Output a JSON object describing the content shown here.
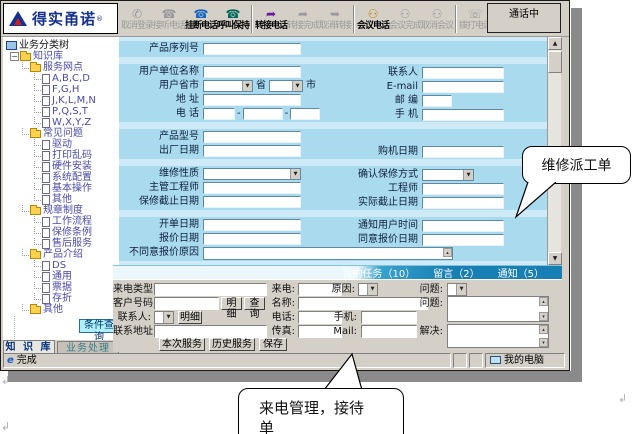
{
  "logo": {
    "brand": "得实甬诺",
    "reg": "®"
  },
  "toolbar": {
    "status": "通话中",
    "buttons": [
      {
        "label": "取消登录",
        "name": "cancel-login-button",
        "icon": "cancel-login-icon",
        "icon_char": "✆",
        "icon_color": "#8a8a8a",
        "enabled": false
      },
      {
        "label": "接听电话",
        "name": "answer-call-button",
        "icon": "answer-call-icon",
        "icon_char": "☎",
        "icon_color": "#8a8a8a",
        "enabled": false
      },
      {
        "label": "挂断电话",
        "name": "hangup-call-button",
        "icon": "hangup-call-icon",
        "icon_char": "☎",
        "icon_color": "#1565c0",
        "enabled": true
      },
      {
        "label": "呼叫保持",
        "name": "hold-call-button",
        "icon": "hold-call-icon",
        "icon_char": "☎",
        "icon_color": "#00695c",
        "enabled": true
      },
      {
        "label": "转接电话",
        "name": "transfer-call-button",
        "icon": "transfer-call-icon",
        "icon_char": "➦",
        "icon_color": "#6a1b9a",
        "enabled": true,
        "group_start": true
      },
      {
        "label": "转接完成",
        "name": "transfer-complete-button",
        "icon": "transfer-complete-icon",
        "icon_char": "➦",
        "icon_color": "#9a9a9a",
        "enabled": false
      },
      {
        "label": "取消转接",
        "name": "cancel-transfer-button",
        "icon": "cancel-transfer-icon",
        "icon_char": "➥",
        "icon_color": "#9a9a9a",
        "enabled": false
      },
      {
        "label": "会议电话",
        "name": "conference-call-button",
        "icon": "conference-call-icon",
        "icon_char": "⚇",
        "icon_color": "#c87f0a",
        "enabled": true,
        "group_start": true
      },
      {
        "label": "会议完成",
        "name": "conference-complete-button",
        "icon": "conference-complete-icon",
        "icon_char": "⚇",
        "icon_color": "#9a9a9a",
        "enabled": false
      },
      {
        "label": "取消会议",
        "name": "cancel-conference-button",
        "icon": "cancel-conference-icon",
        "icon_char": "⚇",
        "icon_color": "#9a9a9a",
        "enabled": false
      },
      {
        "label": "拨打电话",
        "name": "dial-call-button",
        "icon": "dial-call-icon",
        "icon_char": "☏",
        "icon_color": "#555555",
        "enabled": false,
        "group_start": true,
        "dropdown": true
      }
    ]
  },
  "sidebar": {
    "root": "业务分类树",
    "tree": [
      {
        "label": "知识库",
        "level": 1,
        "type": "folder-open",
        "expander": "−"
      },
      {
        "label": "服务网点",
        "level": 2,
        "type": "folder-open"
      },
      {
        "label": "A,B,C,D",
        "level": 3,
        "type": "doc"
      },
      {
        "label": "F,G,H",
        "level": 3,
        "type": "doc"
      },
      {
        "label": "J,K,L,M,N",
        "level": 3,
        "type": "doc"
      },
      {
        "label": "P,Q,S,T",
        "level": 3,
        "type": "doc"
      },
      {
        "label": "W,X,Y,Z",
        "level": 3,
        "type": "doc"
      },
      {
        "label": "常见问题",
        "level": 2,
        "type": "folder-open"
      },
      {
        "label": "驱动",
        "level": 3,
        "type": "doc"
      },
      {
        "label": "打印乱码",
        "level": 3,
        "type": "doc"
      },
      {
        "label": "硬件安装",
        "level": 3,
        "type": "doc"
      },
      {
        "label": "系统配置",
        "level": 3,
        "type": "doc"
      },
      {
        "label": "基本操作",
        "level": 3,
        "type": "doc"
      },
      {
        "label": "其他",
        "level": 3,
        "type": "doc"
      },
      {
        "label": "规章制度",
        "level": 2,
        "type": "folder-open"
      },
      {
        "label": "工作流程",
        "level": 3,
        "type": "doc"
      },
      {
        "label": "保修条例",
        "level": 3,
        "type": "doc"
      },
      {
        "label": "售后服务",
        "level": 3,
        "type": "doc"
      },
      {
        "label": "产品介绍",
        "level": 2,
        "type": "folder-open"
      },
      {
        "label": "DS",
        "level": 3,
        "type": "doc"
      },
      {
        "label": "通用",
        "level": 3,
        "type": "doc"
      },
      {
        "label": "票据",
        "level": 3,
        "type": "doc"
      },
      {
        "label": "存折",
        "level": 3,
        "type": "doc"
      },
      {
        "label": "其他",
        "level": 2,
        "type": "folder-closed"
      }
    ],
    "query_button": "条件查询",
    "tabs": [
      "知 识 库",
      "业务处理"
    ]
  },
  "form": {
    "province": {
      "p1": "省",
      "p2": "市"
    },
    "phone_sep": "-",
    "sections": [
      {
        "rows": [
          {
            "l": "产品序列号",
            "f": {
              "t": "text",
              "w": 98
            }
          }
        ]
      },
      {
        "rows": [
          {
            "l": "用户单位名称",
            "f": {
              "t": "text",
              "w": 98
            },
            "l2": "联系人",
            "f2": {
              "t": "text",
              "w": 82
            }
          },
          {
            "l": "用户省市",
            "f": {
              "t": "prov"
            },
            "l2": "E-mail",
            "f2": {
              "t": "text",
              "w": 82
            }
          },
          {
            "l": "地 址",
            "f": {
              "t": "text",
              "w": 98
            },
            "l2": "邮 编",
            "f2": {
              "t": "text",
              "w": 30
            }
          },
          {
            "l": "电 话",
            "f": {
              "t": "phone"
            },
            "l2": "手 机",
            "f2": {
              "t": "text",
              "w": 82
            }
          }
        ]
      },
      {
        "rows": [
          {
            "l": "产品型号",
            "f": {
              "t": "text",
              "w": 98
            }
          },
          {
            "l": "出厂日期",
            "f": {
              "t": "text",
              "w": 98
            },
            "l2": "购机日期",
            "f2": {
              "t": "text",
              "w": 82
            }
          }
        ]
      },
      {
        "rows": [
          {
            "l": "维修性质",
            "f": {
              "t": "select",
              "w": 98
            },
            "l2": "确认保修方式",
            "f2": {
              "t": "select",
              "w": 52
            }
          },
          {
            "l": "主管工程师",
            "f": {
              "t": "text",
              "w": 98
            },
            "l2": "工程师",
            "f2": {
              "t": "text",
              "w": 82
            }
          },
          {
            "l": "保修截止日期",
            "f": {
              "t": "text",
              "w": 98
            },
            "l2": "实际截止日期",
            "f2": {
              "t": "text",
              "w": 82
            }
          }
        ]
      },
      {
        "rows": [
          {
            "l": "开单日期",
            "f": {
              "t": "text",
              "w": 98
            },
            "l2": "通知用户时间",
            "f2": {
              "t": "text",
              "w": 82
            }
          },
          {
            "l": "报价日期",
            "f": {
              "t": "text",
              "w": 98
            },
            "l2": "同意报价日期",
            "f2": {
              "t": "text",
              "w": 82
            }
          },
          {
            "l": "不同意报价原因",
            "f": {
              "t": "ta",
              "w": 250
            }
          }
        ]
      }
    ]
  },
  "tabstrip": {
    "tabs": [
      "我的任务（10）",
      "留言（2）",
      "通知（5）"
    ]
  },
  "call_panel": {
    "labels": {
      "type": "来电类型:",
      "number": "客户号码:",
      "contact": "联系人:",
      "address": "联系地址:",
      "incoming": "来电:",
      "name": "名称:",
      "phone": "电话:",
      "fax": "传真:",
      "reason": "原因:",
      "issue1": "问题:",
      "issue2": "问题:",
      "mobile": "手机:",
      "mail": "Mail:",
      "solve": "解决:"
    },
    "buttons": {
      "detail1": "明细",
      "query": "查询",
      "detail2": "明细",
      "this_service": "本次服务",
      "history_service": "历史服务",
      "save": "保存"
    }
  },
  "statusbar": {
    "done": "完成",
    "my_computer": "我的电脑"
  },
  "callouts": {
    "repair": "维修派工单",
    "incoming_line1": "来电管理，接待",
    "incoming_line2": "单"
  },
  "icons": {
    "dropdown": "▼",
    "up": "▲",
    "down": "▼",
    "scroll_up": "▴",
    "scroll_down": "▾",
    "ie": "e"
  },
  "artifacts": {
    "mark": "↲"
  },
  "colors": {
    "brand_navy": "#16308e",
    "form_bg": "#a9daee",
    "form_band": "#cdeaf6",
    "strip_blue": "#177fb3",
    "query_button_bg": "#aef0ff",
    "toolbar_bg": "#d4d0c8"
  }
}
